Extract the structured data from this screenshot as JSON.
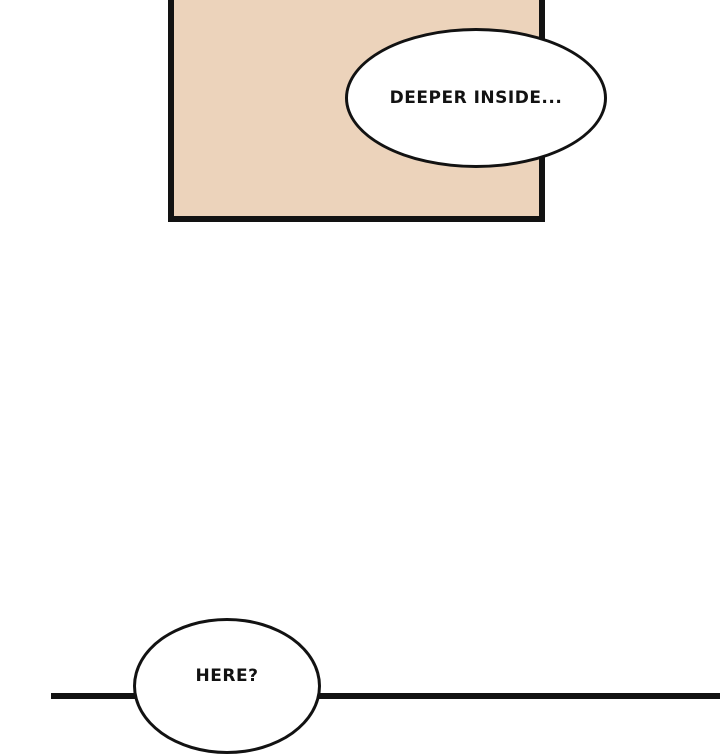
{
  "colors": {
    "background": "#ffffff",
    "ink": "#121212",
    "panel_fill": "#ecd3bb",
    "bubble_fill": "#ffffff"
  },
  "bubbles": {
    "top": {
      "text": "DEEPER INSIDE..."
    },
    "bottom": {
      "text": "HERE?"
    }
  }
}
